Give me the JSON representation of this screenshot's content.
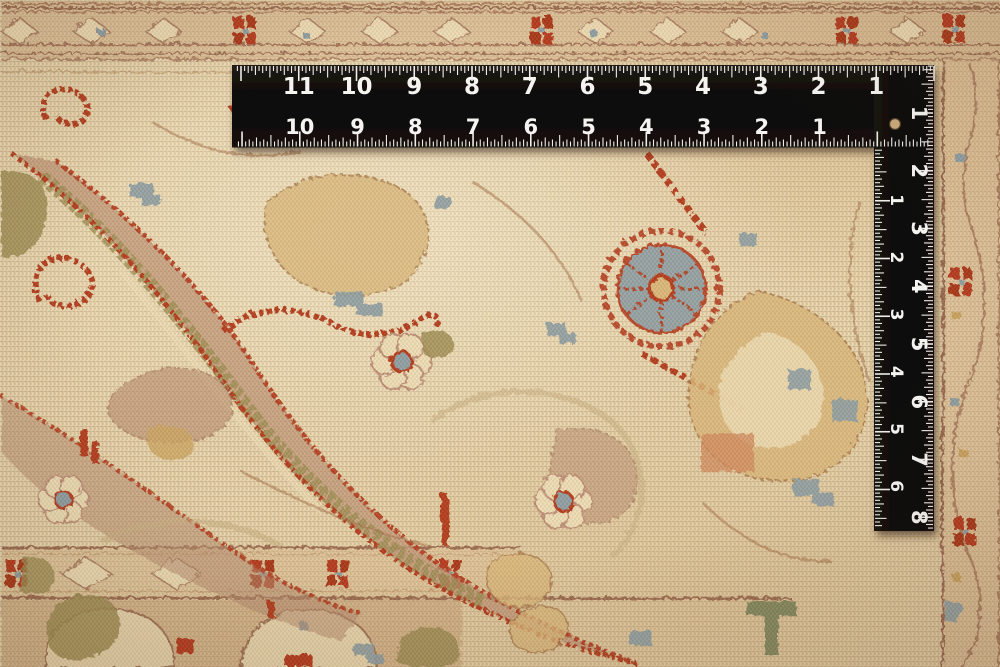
{
  "scene": {
    "subject": "close-up of a hand-knotted oriental rug",
    "overlay_object": "black L-shaped carpenter framing square"
  },
  "ruler": {
    "body_color": "#0f0c09",
    "tick_color": "#efeeea",
    "number_color": "#f5f4f1",
    "blade_top_scale": {
      "unit": "inch",
      "numbers": [
        11,
        10,
        9,
        8,
        7,
        6,
        5,
        4,
        3,
        2,
        1
      ]
    },
    "blade_bottom_scale": {
      "unit": "inch",
      "numbers": [
        10,
        9,
        8,
        7,
        6,
        5,
        4,
        3,
        2,
        1
      ]
    },
    "tongue_outer_scale": {
      "unit": "inch",
      "numbers": [
        1,
        2,
        3,
        4,
        5,
        6,
        7,
        8
      ]
    },
    "tongue_inner_scale": {
      "unit": "inch",
      "numbers": [
        1,
        2,
        3,
        4,
        5,
        6
      ]
    },
    "hanging_hole": "round hole near corner showing rug through it"
  },
  "rug": {
    "palette": {
      "field_cream": "#e4d0a6",
      "weave_shadow": "#8c6438",
      "border_tan": "#d6b28a",
      "madder_red": "#b23b1d",
      "olive_green": "#9c8c52",
      "dark_olive": "#6f7a52",
      "gray_blue": "#8d9da2",
      "mauve_brown": "#b78d6f",
      "gold_tan": "#d9b678",
      "outline_brown": "#9a6b50",
      "salmon": "#cf8a5e"
    },
    "regions": {
      "top_border": "striped guard band with red block motifs and cream chevrons",
      "right_border": "vertical guard band with brown vine and red block motifs",
      "bottom_guard_border": "band with red block motifs over tan palmette border",
      "field": "cream field with sickle leaf, scroll vines, rosettes, palmettes"
    },
    "motifs": [
      "sickle-leaf",
      "red-scroll-vine",
      "rosette-flower",
      "blossom-medallion",
      "gold-palmette",
      "gray-blue-leaf",
      "olive-leaf",
      "red-block-cluster"
    ]
  }
}
